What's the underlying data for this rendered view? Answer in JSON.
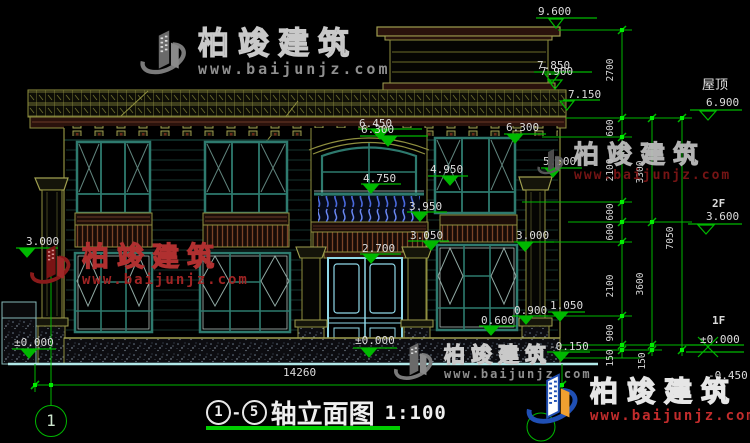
{
  "titlebar": {
    "axis_from": "1",
    "axis_to": "5",
    "separator": "-",
    "title": "轴立面图",
    "scale": "1:100"
  },
  "grid": {
    "bubble_left": "1"
  },
  "watermark": {
    "brand": "柏竣建筑",
    "url": "www.baijunjz.com"
  },
  "levels": {
    "p9600": "9.600",
    "p7850": "7.850",
    "p7900": "7.900",
    "p7150": "7.150",
    "p6450": "6.450",
    "p6300c": "6.300",
    "p6300r": "6.300",
    "p5300": "5.300",
    "p4950": "4.950",
    "p4750": "4.750",
    "p3950": "3.950",
    "p3050": "3.050",
    "p2700": "2.700",
    "p3000r": "3.000",
    "p3000l": "3.000",
    "p0left": "±0.000",
    "p0door": "±0.000",
    "p1050": "1.050",
    "p0900": "0.900",
    "p0600": "0.600",
    "pm0150": "-0.150"
  },
  "floors": {
    "roof_name": "屋顶",
    "roof_level": "6.900",
    "f2_name": "2F",
    "f2_level": "3.600",
    "f1_name": "1F",
    "f1_level": "±0.000",
    "ground_level": "-0.450"
  },
  "dims": {
    "total_width": "14260",
    "v2700": "2700",
    "v600a": "600",
    "v2100a": "2100",
    "v600b": "600",
    "v600c": "600",
    "v2100b": "2100",
    "v900": "900",
    "v150a": "150",
    "v3300": "3300",
    "v3600": "3600",
    "v150b": "150",
    "v7050": "7050"
  },
  "colors": {
    "dim_green": "#00b800",
    "cad_white": "#dcdcdc",
    "trim_yellow": "#8f8f3f",
    "frame_teal": "#2e7a6e",
    "door_cyan": "#8fd8e8",
    "baluster_blue": "#4a6ae0",
    "fascia_maroon": "#2a120c",
    "logo_blue": "#1f4fb4",
    "logo_orange": "#f0a030"
  }
}
